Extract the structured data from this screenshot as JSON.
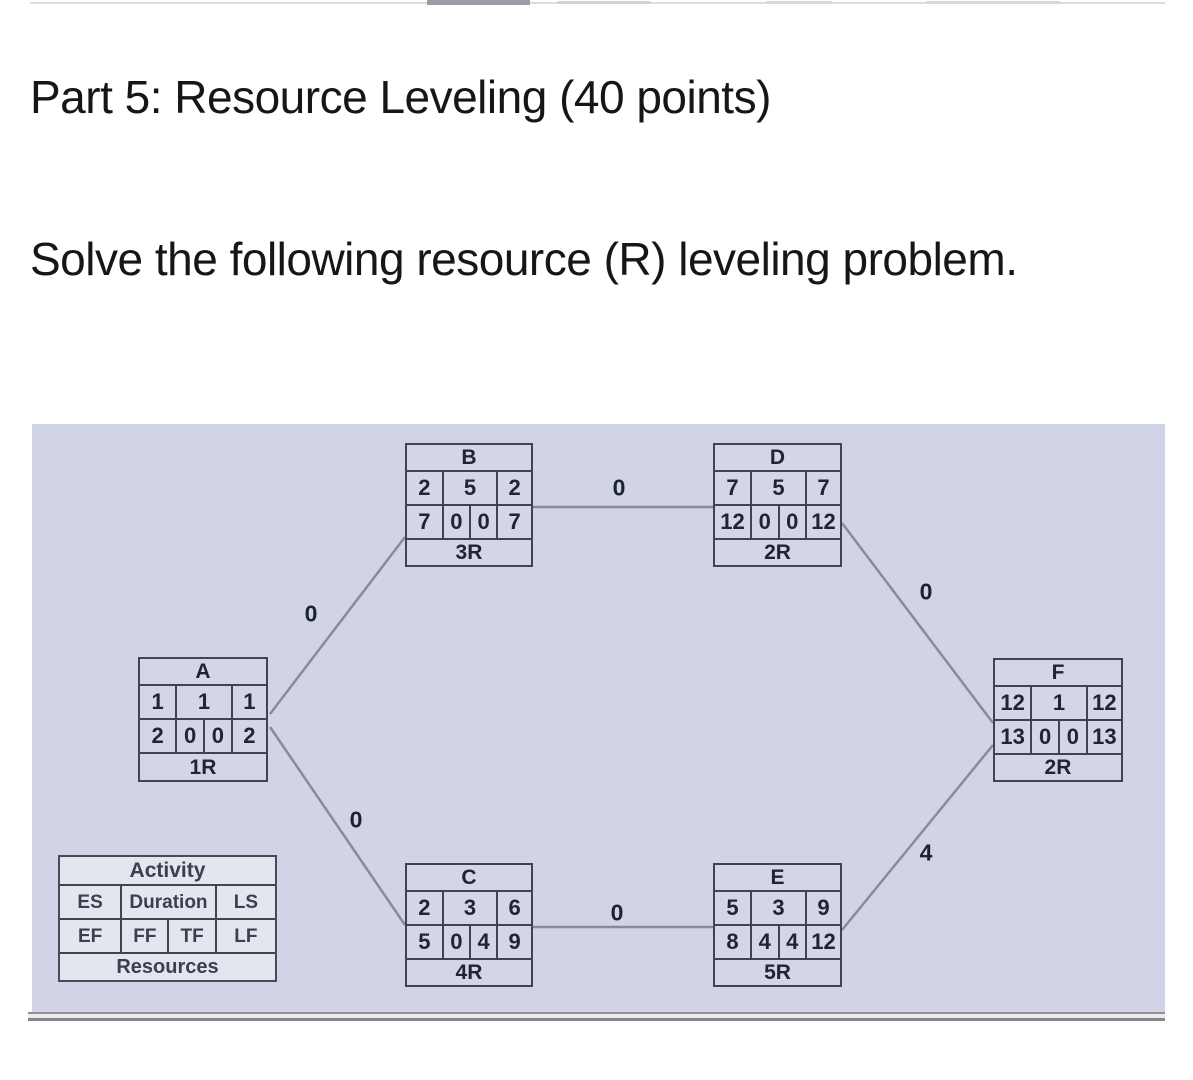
{
  "page": {
    "title": "Part 5: Resource Leveling (40 points)",
    "subtitle": "Solve the following resource (R) leveling problem."
  },
  "colors": {
    "diagram_background": "#d0d4e6",
    "node_border": "#43434d",
    "edge_line": "#8b8b95"
  },
  "legend": {
    "title": "Activity",
    "es_label": "ES",
    "duration_label": "Duration",
    "ls_label": "LS",
    "ef_label": "EF",
    "ff_label": "FF",
    "tf_label": "TF",
    "lf_label": "LF",
    "footer": "Resources"
  },
  "nodes": [
    {
      "id": "A",
      "es": "1",
      "duration": "1",
      "ls": "1",
      "ef": "2",
      "ff": "0",
      "tf": "0",
      "lf": "2",
      "resources": "1R"
    },
    {
      "id": "B",
      "es": "2",
      "duration": "5",
      "ls": "2",
      "ef": "7",
      "ff": "0",
      "tf": "0",
      "lf": "7",
      "resources": "3R"
    },
    {
      "id": "C",
      "es": "2",
      "duration": "3",
      "ls": "6",
      "ef": "5",
      "ff": "0",
      "tf": "4",
      "lf": "9",
      "resources": "4R"
    },
    {
      "id": "D",
      "es": "7",
      "duration": "5",
      "ls": "7",
      "ef": "12",
      "ff": "0",
      "tf": "0",
      "lf": "12",
      "resources": "2R"
    },
    {
      "id": "E",
      "es": "5",
      "duration": "3",
      "ls": "9",
      "ef": "8",
      "ff": "4",
      "tf": "4",
      "lf": "12",
      "resources": "5R"
    },
    {
      "id": "F",
      "es": "12",
      "duration": "1",
      "ls": "12",
      "ef": "13",
      "ff": "0",
      "tf": "0",
      "lf": "13",
      "resources": "2R"
    }
  ],
  "edges": [
    {
      "from": "A",
      "to": "B",
      "label": "0"
    },
    {
      "from": "A",
      "to": "C",
      "label": "0"
    },
    {
      "from": "B",
      "to": "D",
      "label": "0"
    },
    {
      "from": "C",
      "to": "E",
      "label": "0"
    },
    {
      "from": "D",
      "to": "F",
      "label": "0"
    },
    {
      "from": "E",
      "to": "F",
      "label": "4"
    }
  ]
}
